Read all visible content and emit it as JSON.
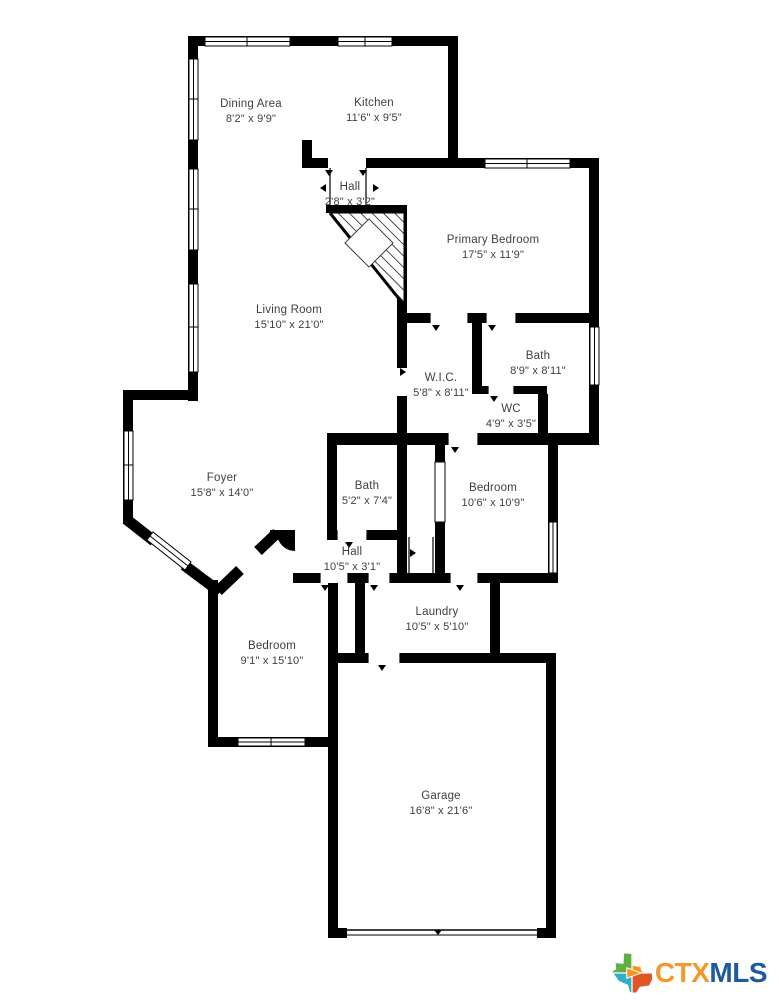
{
  "plan": {
    "rooms": [
      {
        "name": "Dining Area",
        "dims": "8'2\" x 9'9\""
      },
      {
        "name": "Kitchen",
        "dims": "11'6\" x 9'5\""
      },
      {
        "name": "Hall",
        "dims": "2'8\" x 3'2\""
      },
      {
        "name": "Primary Bedroom",
        "dims": "17'5\" x 11'9\""
      },
      {
        "name": "Living Room",
        "dims": "15'10\" x 21'0\""
      },
      {
        "name": "W.I.C.",
        "dims": "5'8\" x 8'11\""
      },
      {
        "name": "Bath",
        "dims": "8'9\" x 8'11\""
      },
      {
        "name": "WC",
        "dims": "4'9\" x 3'5\""
      },
      {
        "name": "Foyer",
        "dims": "15'8\" x 14'0\""
      },
      {
        "name": "Bath",
        "dims": "5'2\" x 7'4\""
      },
      {
        "name": "Bedroom",
        "dims": "10'6\" x 10'9\""
      },
      {
        "name": "Hall",
        "dims": "10'5\" x 3'1\""
      },
      {
        "name": "Laundry",
        "dims": "10'5\" x 5'10\""
      },
      {
        "name": "Bedroom",
        "dims": "9'1\" x 15'10\""
      },
      {
        "name": "Garage",
        "dims": "16'8\" x 21'6\""
      }
    ],
    "colors": {
      "wall": "#000000",
      "label_text": "#3e3e3e",
      "background": "#ffffff"
    }
  },
  "logo": {
    "ctx": "CTX",
    "mls": "MLS",
    "ctx_color": "#F2992E",
    "mls_color": "#1E5B9E",
    "texas_icon_colors": {
      "top_left_green": "#5FAE46",
      "arrow_orange": "#F7941E",
      "bottom_left_teal": "#31AEC4",
      "bottom_right_red": "#E05425"
    }
  }
}
